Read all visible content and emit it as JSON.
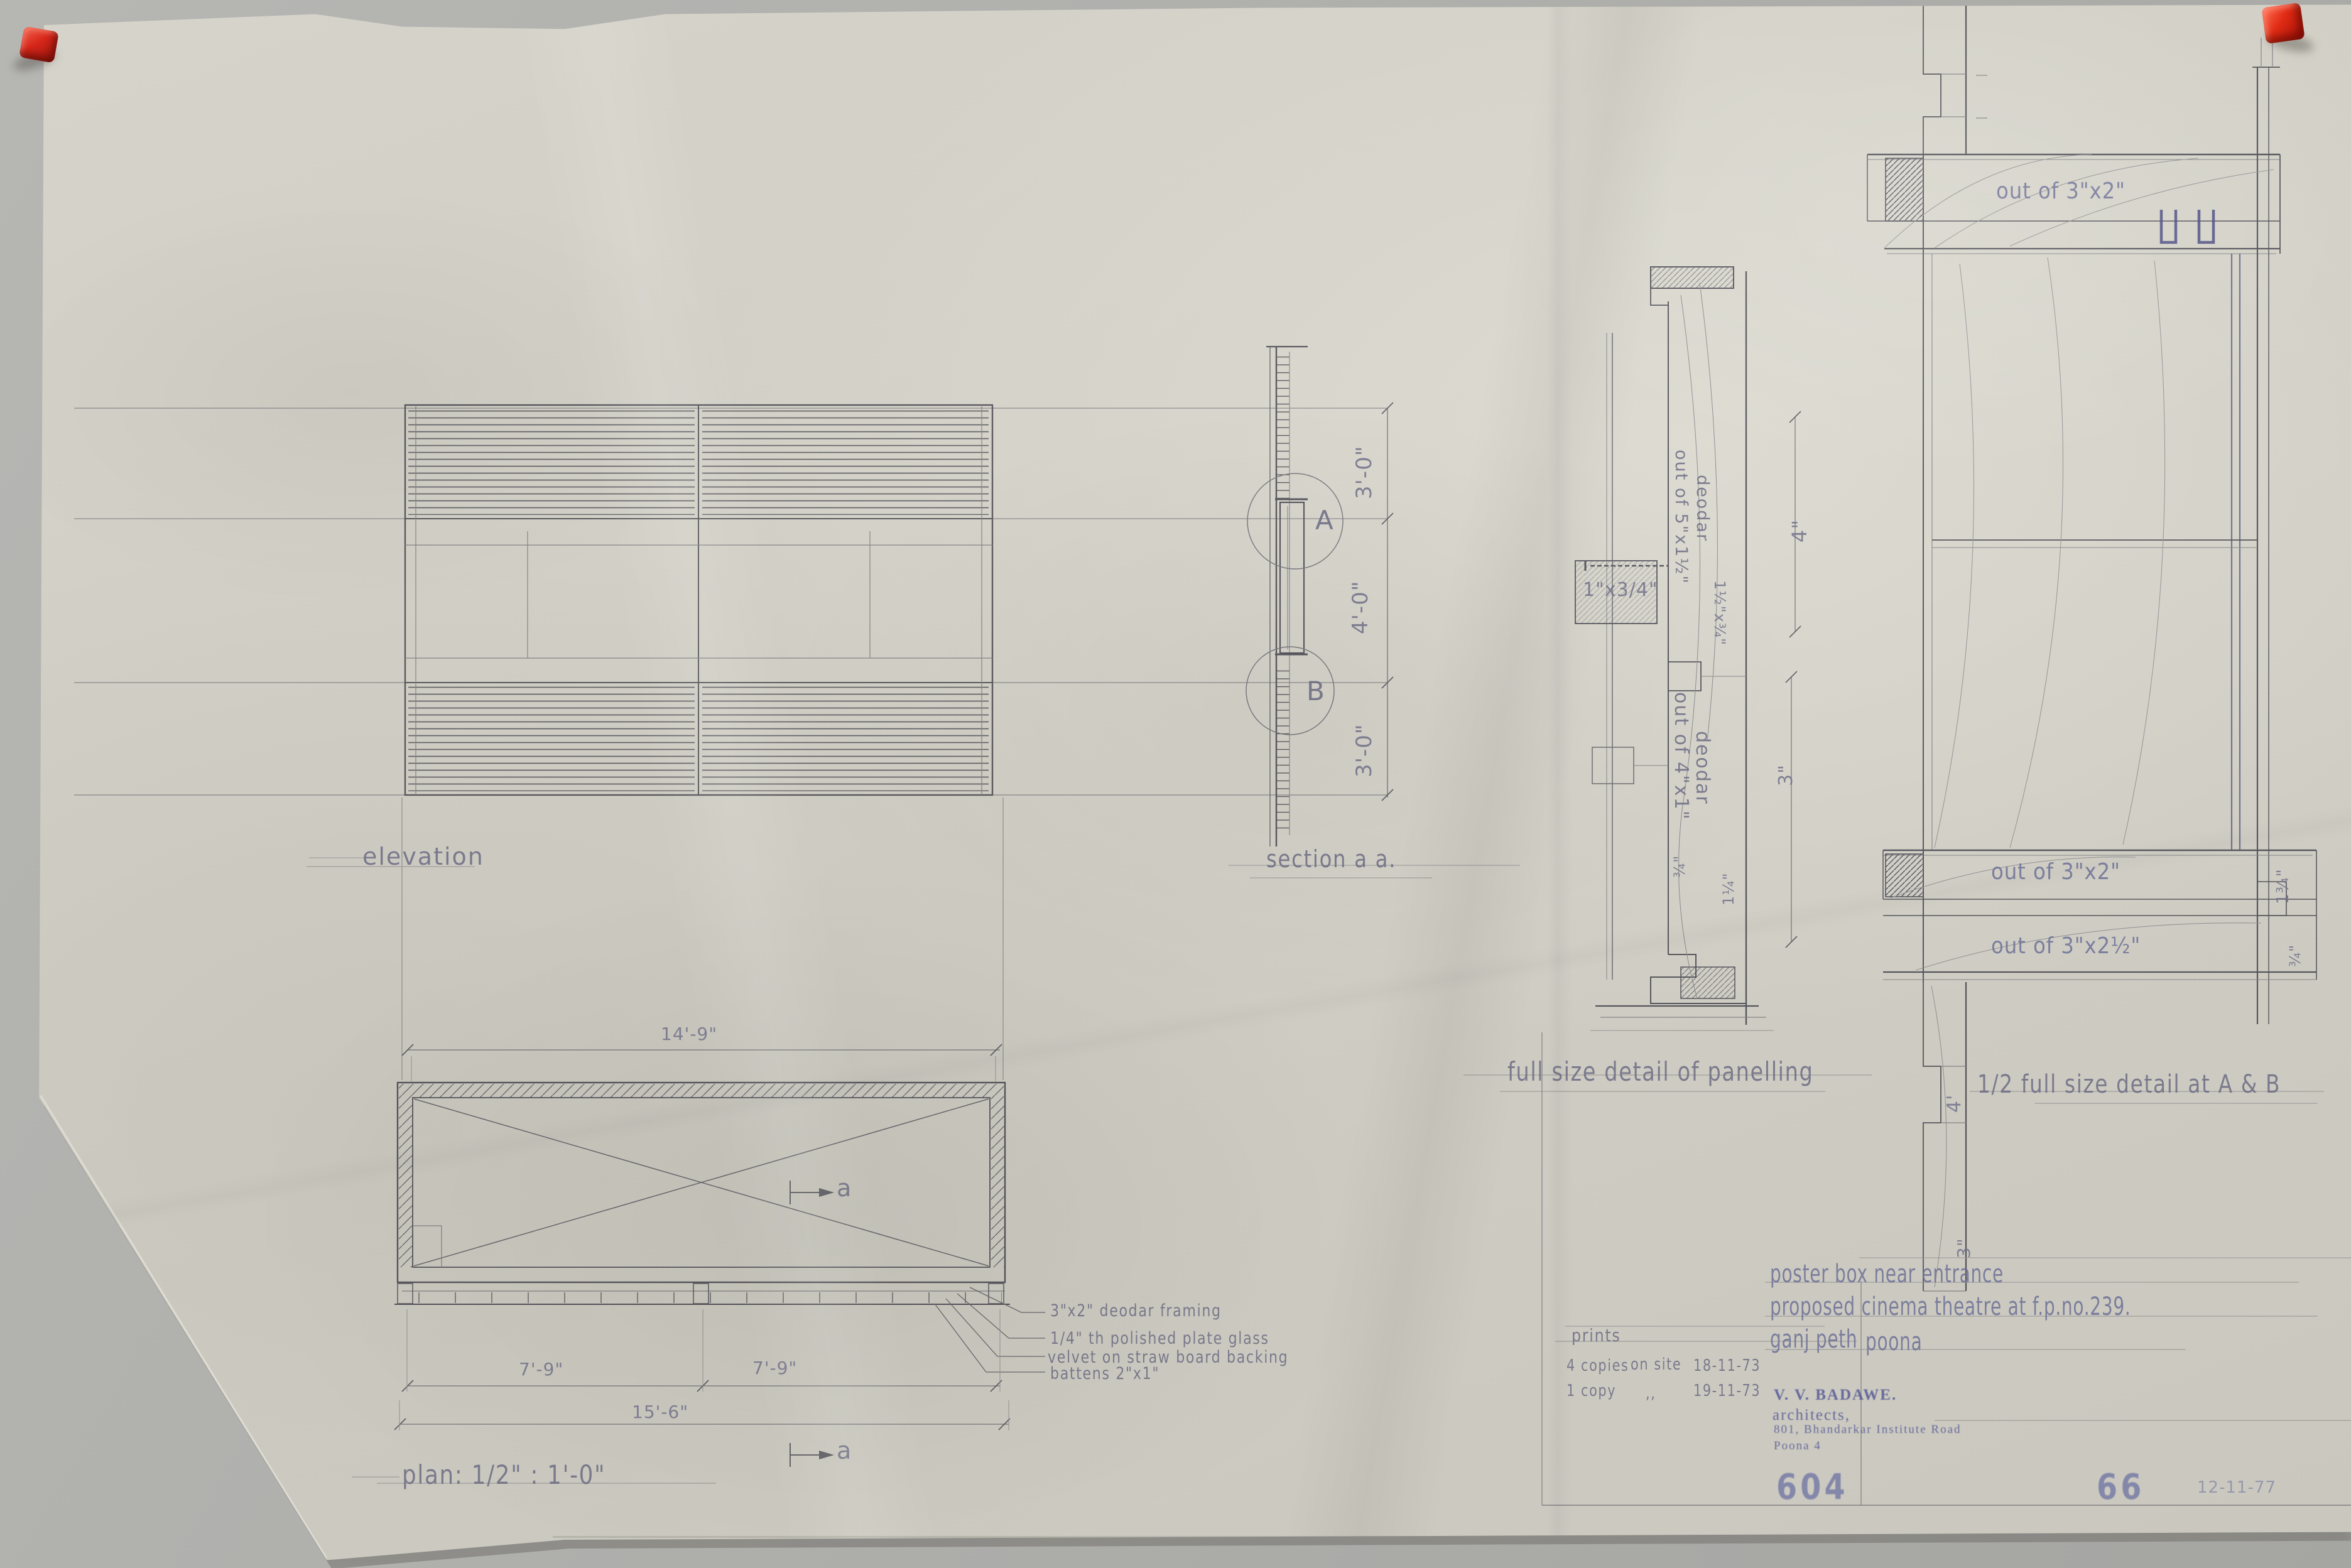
{
  "drawing": {
    "elevation_label": "elevation",
    "section_label": "section a a.",
    "section": {
      "circle_a": "A",
      "circle_b": "B",
      "dim_top": "3'-0\"",
      "dim_mid": "4'-0\"",
      "dim_bottom": "3'-0\""
    },
    "panelling": {
      "label": "full size detail of panelling",
      "member_top_1": "out of 5\"x1½\"",
      "member_top_2": "deodar",
      "member_bottom_1": "out of 4\"x1\"",
      "member_bottom_2": "deodar",
      "block_label": "1\"x3/4\"",
      "dim_small": "1½\"x¾\"",
      "dim_right_top": "4\"",
      "dim_right_bottom": "3\"",
      "dim_foot_a": "¾\"",
      "dim_foot_b": "1¼\""
    },
    "half_detail": {
      "label": "1/2 full size detail at  A & B",
      "top_member": "out of 3\"x2\"",
      "bottom_member_1": "out of 3\"x2\"",
      "bottom_member_2": "out of 3\"x2½\"",
      "dim_right_1": "1¾\"",
      "dim_right_2": "¾\"",
      "dim_left": "4'",
      "dim_bottom": "3\""
    },
    "plan": {
      "label": "plan: 1/2\" : 1'-0\"",
      "dim_width_top": "14'-9\"",
      "dim_half_left": "7'-9\"",
      "dim_half_right": "7'-9\"",
      "dim_total": "15'-6\"",
      "marker_top": "a",
      "marker_bottom": "a",
      "notes": [
        "3\"x2\" deodar framing",
        "1/4\" th polished plate glass",
        "velvet on straw board backing",
        "battens 2\"x1\""
      ]
    }
  },
  "prints": {
    "title": "prints",
    "row1": [
      "4 copies",
      "on site",
      "18-11-73"
    ],
    "row2": [
      "1 copy",
      ",,",
      "19-11-73"
    ]
  },
  "title_block": {
    "line1": "poster box near entrance",
    "line2": "proposed cinema theatre at f.p.no.239.",
    "location_1": "ganj peth",
    "location_2": "poona",
    "stamp_name": "V. V. BADAWE.",
    "stamp_role": "architects,",
    "stamp_address": "801, Bhandarkar Institute Road",
    "stamp_city": "Poona 4",
    "drawing_no": "604",
    "sheet_no": "66",
    "date": "12-11-77"
  },
  "colors": {
    "paper": "#d1cfc5",
    "pencil": "#6b6b80",
    "blue_pencil": "#5054a0",
    "stamp_blue": "#4a4e92",
    "pin_red": "#d7271a"
  }
}
